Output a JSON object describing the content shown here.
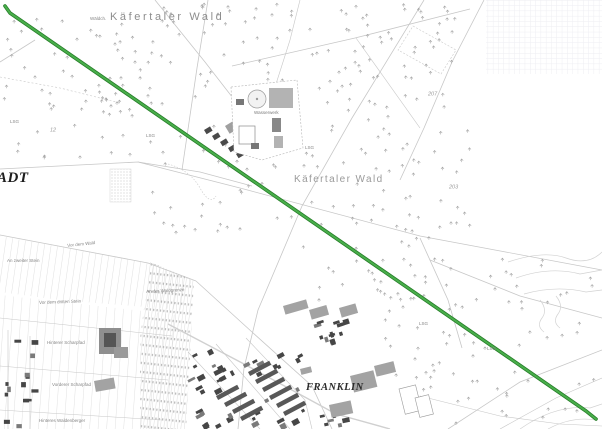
{
  "map": {
    "forest_title_top": "Käfertaler Wald",
    "forest_label_mid": "Käfertaler Wald",
    "district_partial_left": "ADT",
    "district_franklin": "FRANKLIN",
    "facility_label": "Wasserwerk",
    "small_wood_label": "Wäldch.",
    "field_names": {
      "vor_dem_wald": "Vor dem Wald",
      "an_zweiter_stein": "An zweiter Stein",
      "vor_dem_dritten_stein": "Vor dem dritten Stein",
      "an_der_waldgrenze": "An der Waldgrenze",
      "hinterer_scharpfad": "Hinterer Scharpfad",
      "vorderer_scharpfad": "Vorderer Scharpfad",
      "hinteres_waldenberger": "Hinteres Waldenberger"
    },
    "lsg_abbr": "LSG",
    "parcel_numbers": {
      "p207": "207",
      "p203": "203",
      "p12": "12"
    },
    "route_color": "#49ae4b",
    "route_edge_color": "#267d28",
    "grid_color": "#ededf2"
  }
}
